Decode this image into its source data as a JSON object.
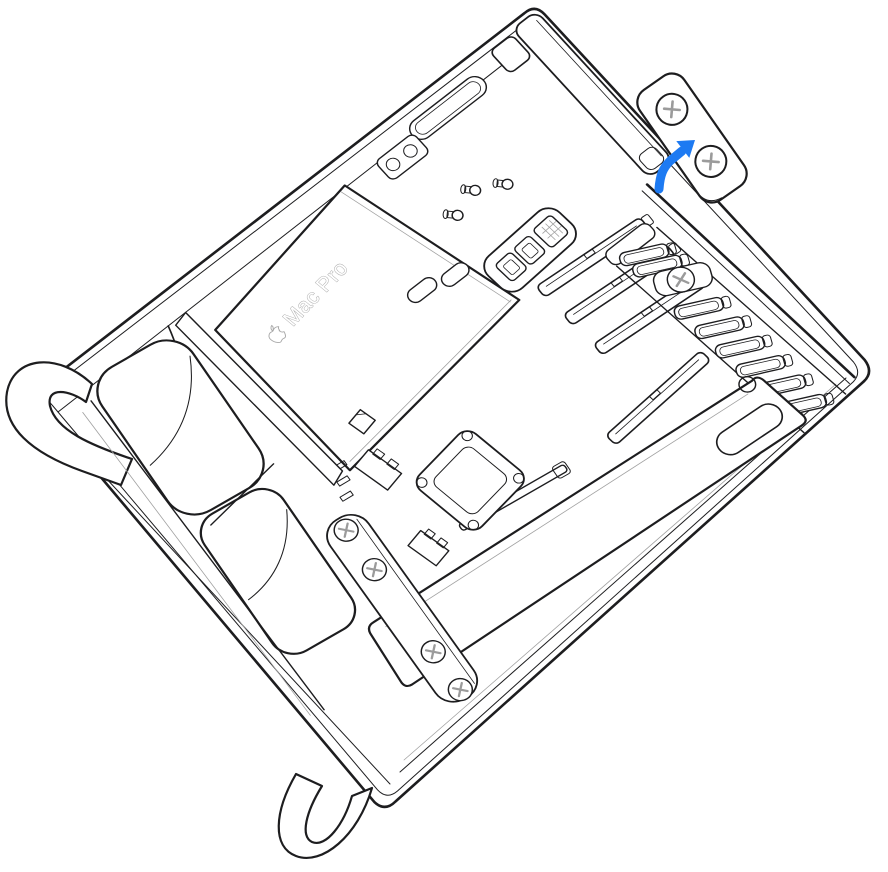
{
  "figure": {
    "alt": "Line-art illustration of a Mac Pro lying on its side with the housing removed; a blue arrow shows the PCIe lock bracket with two screws being lifted away from the enclosure.",
    "width_px": 888,
    "height_px": 872,
    "background": "#ffffff"
  },
  "device": {
    "label": "Mac Pro",
    "brand_icon": "apple-logo"
  },
  "bracket": {
    "name": "PCIe lock bracket",
    "screw_count": 2
  },
  "callout": {
    "name": "removal-arrow",
    "direction": "up-right",
    "points_to": "pcie-lock-bracket"
  },
  "colors": {
    "line": "#1d1d1f",
    "line_light": "#a2a2a2",
    "arrow": "#1d7af2",
    "bracket_fill": "#ededed",
    "screw_fill": "#e8e8e8",
    "screw_cross": "#9b9b9b",
    "label_outline": "#a8a8a8",
    "background": "#ffffff"
  },
  "parts": [
    "enclosure-frame",
    "top-cap-panel",
    "rim-vent-slot",
    "rim-latch-bracket",
    "corner-cap",
    "psu-cover",
    "device-label",
    "io-ports",
    "standoff-posts",
    "pcie-slots",
    "pcie-slot-covers",
    "logic-board-socket",
    "cable-bar",
    "screw-rail",
    "fan-assembly",
    "handle-cutout",
    "support-foot-left",
    "support-foot-bottom",
    "pcie-lock-bracket",
    "removal-arrow"
  ]
}
